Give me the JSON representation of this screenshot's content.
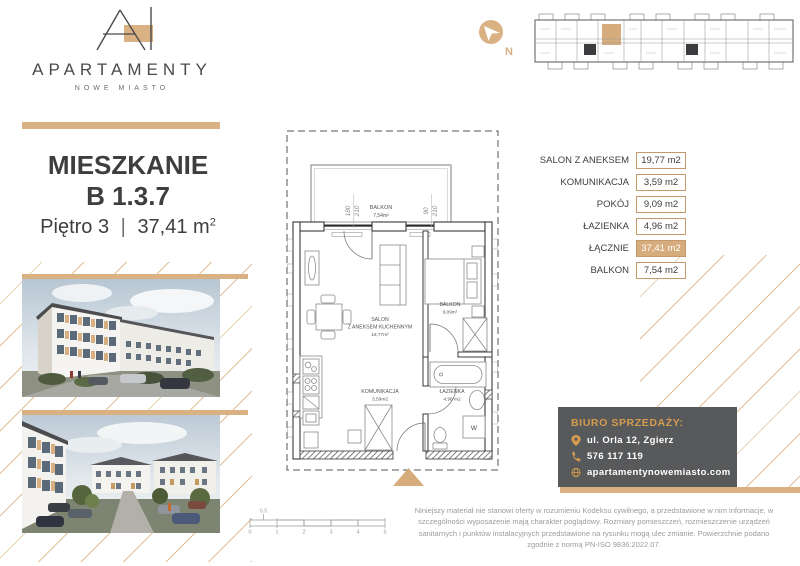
{
  "brand": {
    "name": "APARTAMENTY",
    "tagline": "NOWE MIASTO"
  },
  "listing": {
    "type_label": "MIESZKANIE",
    "unit_number": "B 1.3.7",
    "floor_label": "Piętro 3",
    "divider": "|",
    "area_value": "37,41 m",
    "area_exponent": "2"
  },
  "compass": {
    "north_label": "N"
  },
  "area_table": {
    "rows": [
      {
        "label": "SALON Z ANEKSEM",
        "value": "19,77 m2"
      },
      {
        "label": "KOMUNIKACJA",
        "value": "3,59 m2"
      },
      {
        "label": "POKÓJ",
        "value": "9,09 m2"
      },
      {
        "label": "ŁAZIENKA",
        "value": "4,96 m2"
      },
      {
        "label": "ŁĄCZNIE",
        "value": "37,41 m2"
      },
      {
        "label": "BALKON",
        "value": "7,54 m2"
      }
    ]
  },
  "floor_plan": {
    "balcony": {
      "name": "BALKON",
      "area": "7,54m²"
    },
    "living_room": {
      "line1": "SALON",
      "line2": "Z ANEKSEM KUCHENNYM",
      "area": "19,77m²"
    },
    "bedroom": {
      "name": "BALKON",
      "area": "9,09m²"
    },
    "hallway": {
      "name": "KOMUNIKACJA",
      "area": "3,59m2"
    },
    "bathroom": {
      "name": "ŁAZIENKA",
      "area": "4,96 m2"
    },
    "washer_label": "W",
    "window_dims": {
      "w1_width": "180",
      "w1_height": "210",
      "w2_width": "90",
      "w2_height": "210"
    },
    "scale_bar": {
      "half": "0.5",
      "ticks": [
        "0",
        "1",
        "2",
        "3",
        "4",
        "5"
      ]
    }
  },
  "sales_office": {
    "heading": "BIURO SPRZEDAŻY:",
    "address": "ul. Orla 12, Zgierz",
    "phone": "576 117 119",
    "website": "apartamentynowemiasto.com"
  },
  "disclaimer": "Niniejszy materiał nie stanowi oferty w rozumieniu Kodeksu cywilnego, a przedstawione w nim informacje, w szczególności wyposażenie mają charakter poglądowy. Rozmiary pomieszczeń, rozmieszczenie urządzeń sanitarnych i punktów instalacyjnych przedstawione na rysunku mogą ulec zmianie. Powierzchnie podano zgodnie z normą PN-ISO 9836:2022.07.",
  "colors": {
    "gold": "#D9B183",
    "tan_highlight": "#D6AC7C",
    "table_border": "#C49A6C",
    "dark_text": "#3E3E40",
    "card_bg": "#58595B",
    "card_gold": "#D49C4E"
  }
}
